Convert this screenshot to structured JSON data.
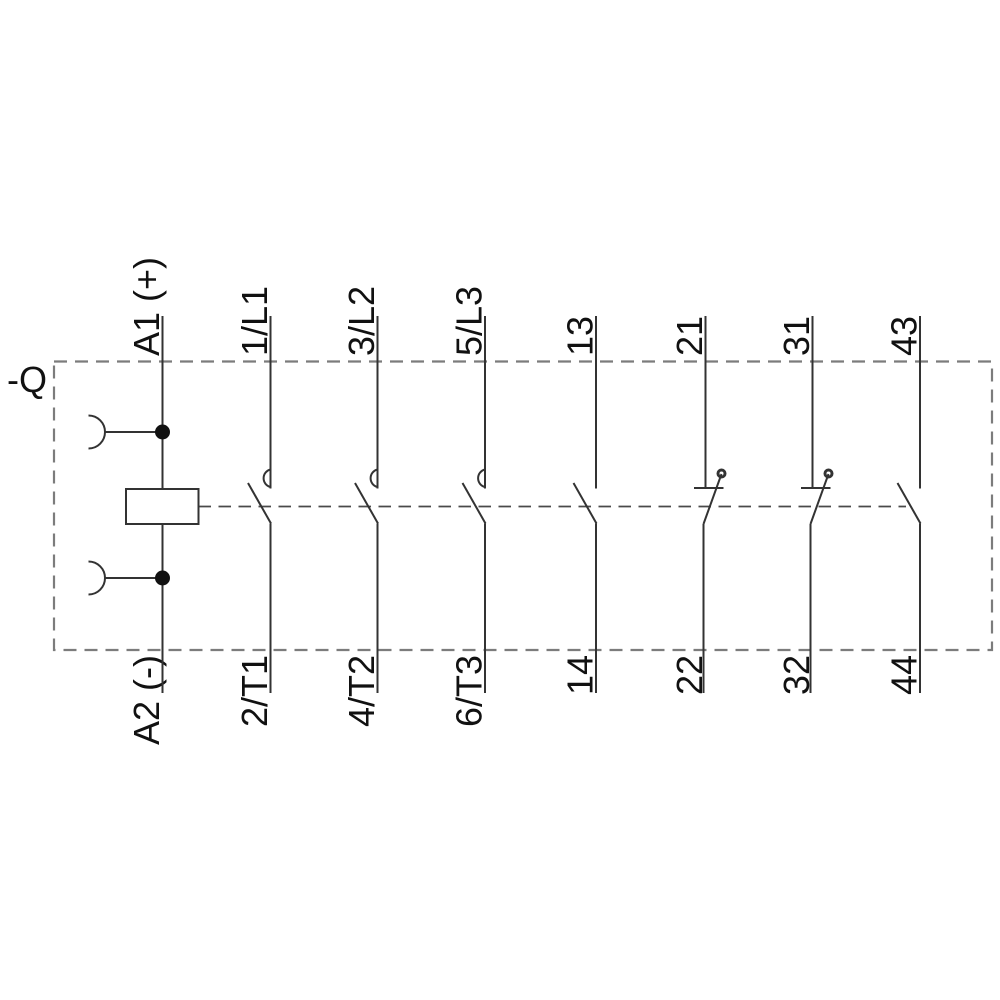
{
  "device_label": "-Q",
  "poles": [
    {
      "type": "coil",
      "top_label": "A1 (+)",
      "bottom_label": "A2 (-)"
    },
    {
      "type": "main_no",
      "top_label": "1/L1",
      "bottom_label": "2/T1"
    },
    {
      "type": "main_no",
      "top_label": "3/L2",
      "bottom_label": "4/T2"
    },
    {
      "type": "main_no",
      "top_label": "5/L3",
      "bottom_label": "6/T3"
    },
    {
      "type": "aux_no",
      "top_label": "13",
      "bottom_label": "14"
    },
    {
      "type": "aux_nc",
      "top_label": "21",
      "bottom_label": "22"
    },
    {
      "type": "aux_nc",
      "top_label": "31",
      "bottom_label": "32"
    },
    {
      "type": "aux_no",
      "top_label": "43",
      "bottom_label": "44"
    }
  ],
  "colors": {
    "wire": "#333333",
    "box_dash": "#7c7c7c",
    "linkage_dash": "#4a4a4a",
    "text": "#111111"
  }
}
